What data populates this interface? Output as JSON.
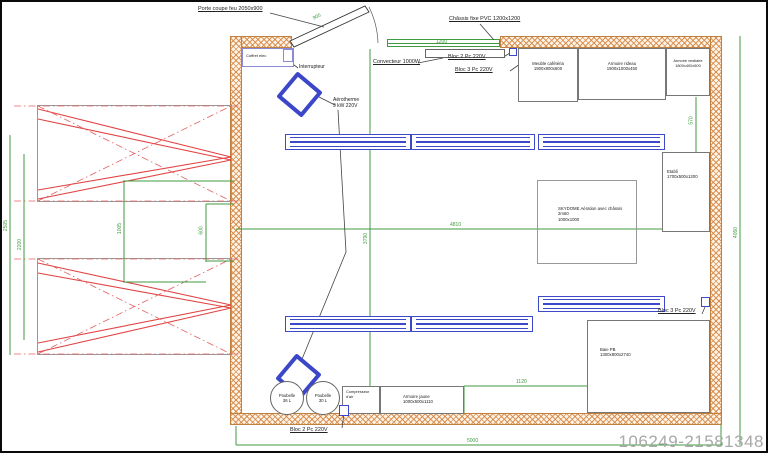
{
  "watermark": "106249-21581348",
  "colors": {
    "wall_hatch": "#d6823e",
    "dimension_green": "#3f9b3f",
    "equipment_blue": "#3b46c9",
    "structure_red": "#e14343",
    "watermark_gray": "#a9a9a9"
  },
  "annotations": {
    "porte_coupe_feu": "Porte coupe feu 2050x900",
    "chassis_fixe": "Châssis fixe PVC 1200x1200",
    "convecteur": "Convecteur 1000W",
    "bloc2_top": "Bloc 2 Pc 220V",
    "bloc3_top": "Bloc 3 Pc 220V",
    "bloc3_mid": "Bloc 3 Pc 220V",
    "bloc2_bottom": "Bloc 2 Pc 220V",
    "coffret": "Coffret elec",
    "interrupteur": "Interrupteur",
    "aerotherme_line1": "Aérotherme",
    "aerotherme_line2": "9 kW 220V"
  },
  "furniture": {
    "meuble_cafeteria": {
      "name": "Meuble cafétéria",
      "size": "1900x900x600"
    },
    "armoire_rideau": {
      "name": "Armoire rideau",
      "size": "1900x1000x450"
    },
    "armoire_vestiaire": {
      "name": "Armoire vestiaire",
      "size": "1800x400x500"
    },
    "etabli": {
      "name": "Etabli",
      "size": "1700x500x1200"
    },
    "skydome": {
      "line1": "SKYDOME Aération avec châssis",
      "line2": "2m60",
      "line3": "1000x1000"
    },
    "baie_pb": {
      "name": "Baie PB",
      "size": "1300x800x2740"
    },
    "armoire_jaune": {
      "name": "Armoire jaune",
      "size": "1000x500x1110"
    },
    "compresseur": {
      "line1": "Compresseur",
      "line2": "d'air"
    },
    "poubelle_1": {
      "name": "Poubelle",
      "size": "36 L"
    },
    "poubelle_2": {
      "name": "Poubelle",
      "size": "30 L"
    }
  },
  "dimensions": {
    "window_width": "1200",
    "door_width": "900",
    "interior_width": "4810",
    "interior_depth": "3790",
    "overall_width": "5000",
    "overall_depth": "4050",
    "right_top": "570",
    "bottom_right": "1120",
    "left_outer": "2505",
    "left_inner": "2200",
    "left_mid": "1005",
    "left_small": "600"
  }
}
